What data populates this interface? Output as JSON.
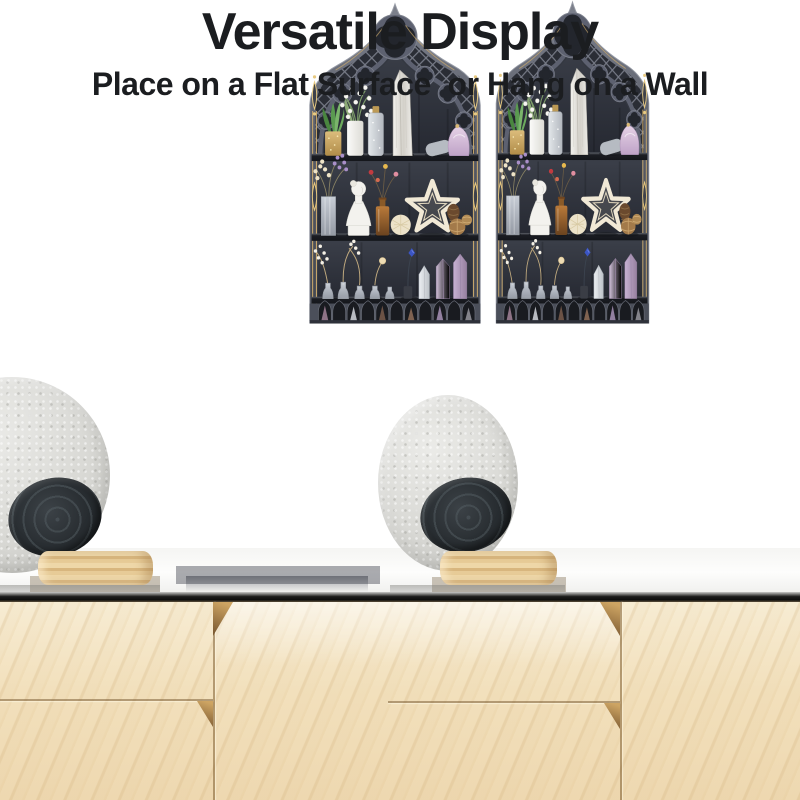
{
  "heading": {
    "title": "Versatile Display",
    "subtitle": "Place on a Flat Surface  or Hang on a Wall"
  },
  "scenes": [
    {
      "placement": "flat-surface"
    },
    {
      "placement": "wall-hung"
    }
  ],
  "shelf_items": {
    "top_shelf": [
      "succulent-in-gold-glitter-vase",
      "lily-of-the-valley-in-white-vase",
      "glitter-bottle-with-cork",
      "selenite-crystal-tower",
      "lying-corked-bottle",
      "pink-crystal-pouch"
    ],
    "middle_shelf": [
      "dried-flowers-in-glass-vase",
      "white-goddess-bust",
      "amber-bottle-with-rosebuds",
      "cream-pompom",
      "white-wicker-star",
      "pinecone-and-rattan-balls"
    ],
    "bottom_shelf": [
      "mini-glass-vases-with-dried-sprigs",
      "cream-flower",
      "blue-flower",
      "clear-quartz-point",
      "amethyst-tower-small",
      "amethyst-tower-large"
    ]
  },
  "colors": {
    "text": "#1b1d20",
    "shelf_frame": "#585c68",
    "shelf_back_panel": "#2a2d35",
    "gold_trim": "#d3af6d",
    "cabinet_wood": "#f2e0bc",
    "counter_edge": "#0e0e0d",
    "felt_disc": "#d9d9d5",
    "black_plate": "#282d31",
    "wood_tray": "#e0bf8a"
  }
}
